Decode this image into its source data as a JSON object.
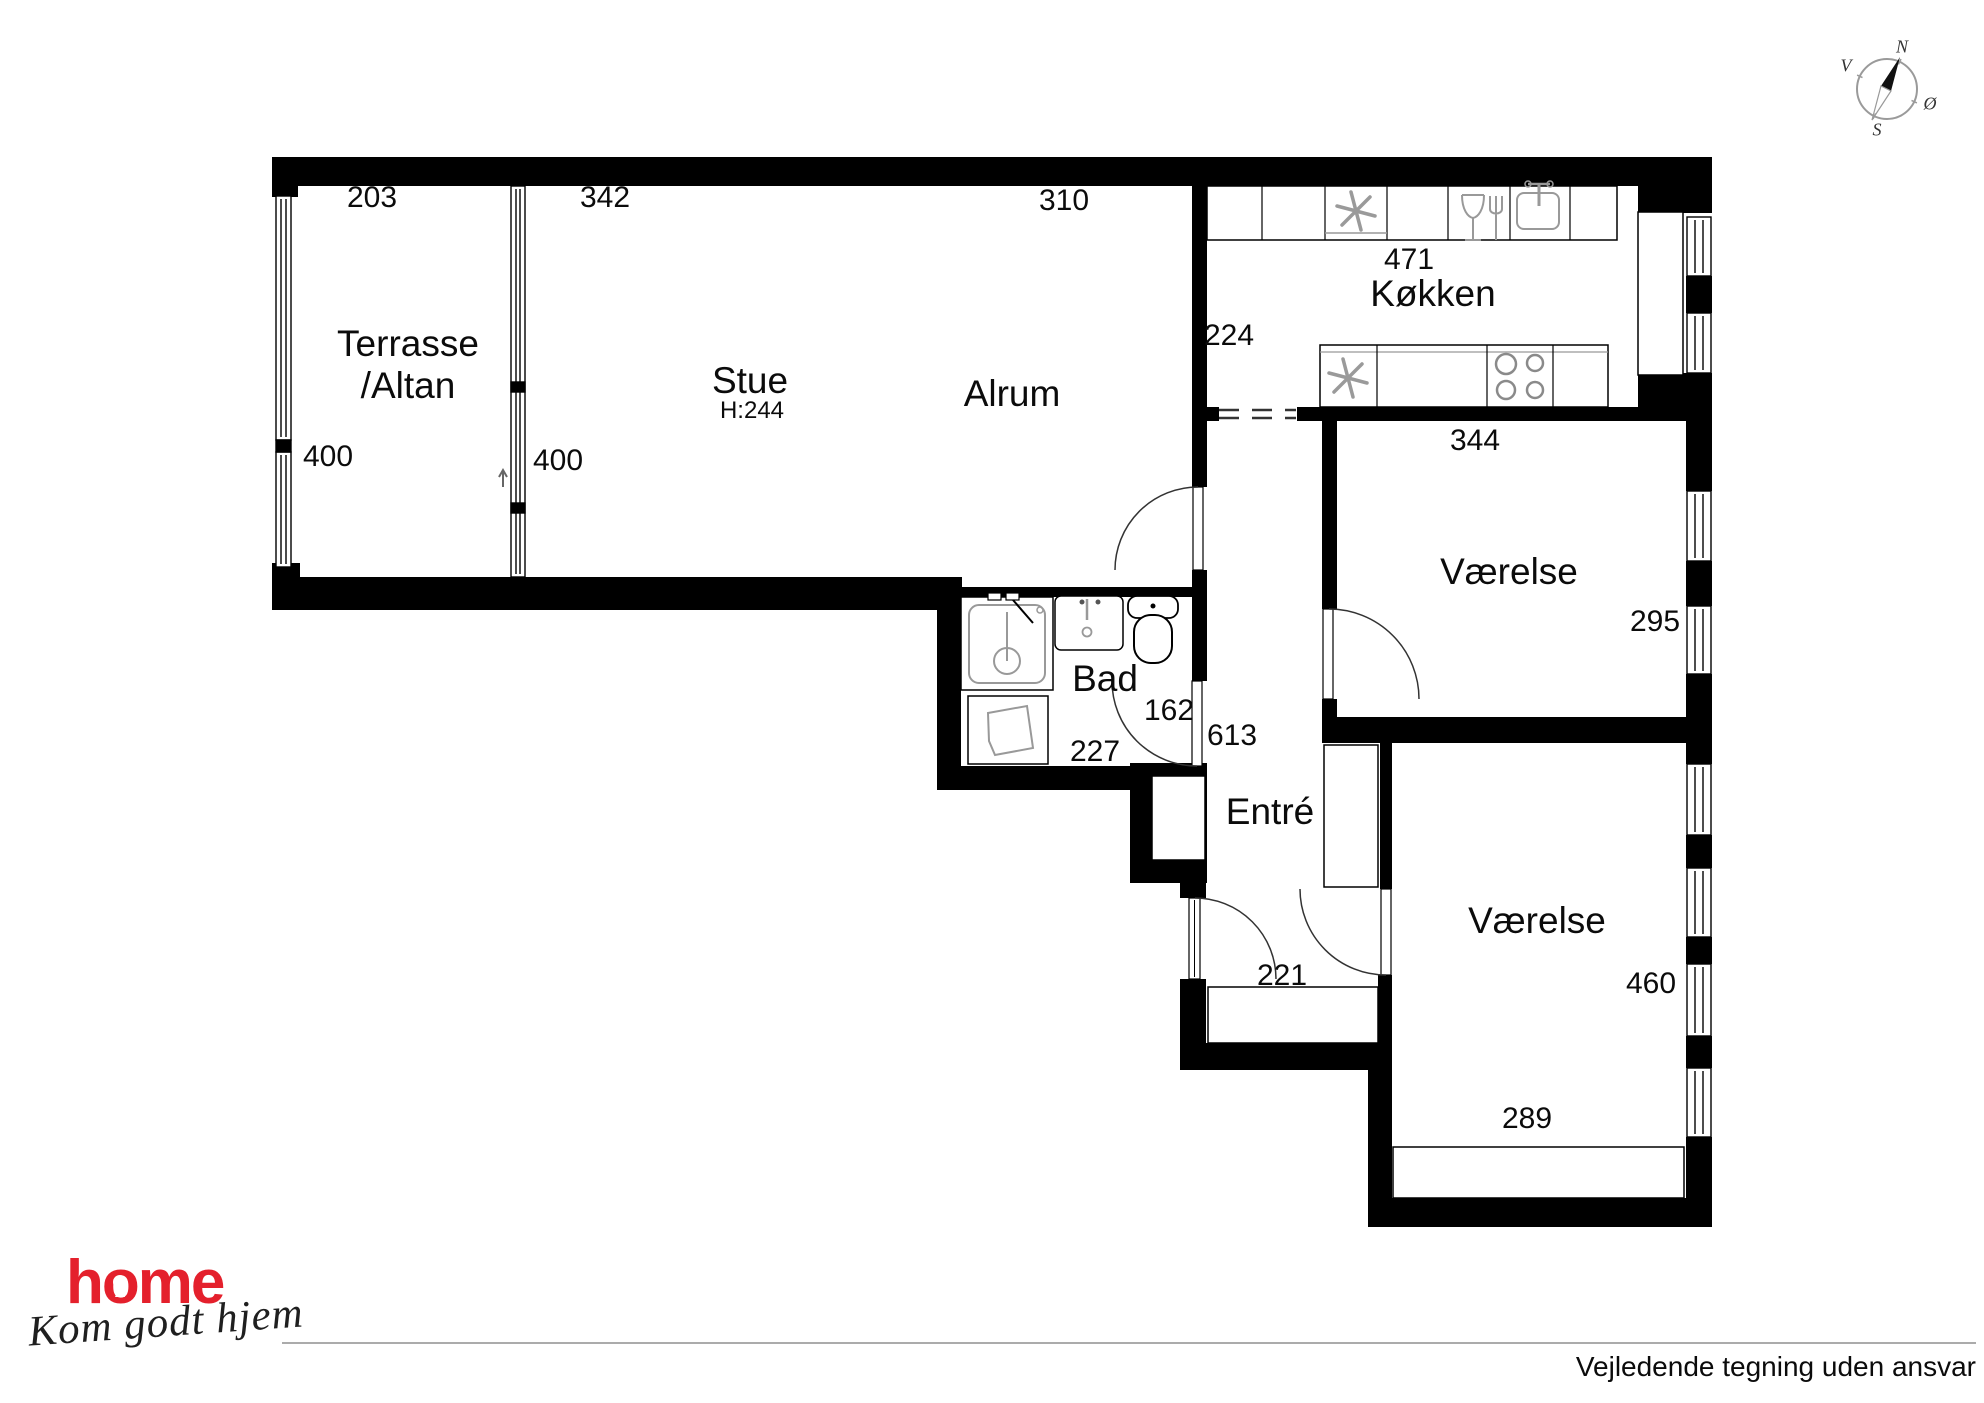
{
  "plan": {
    "rooms": {
      "terrasse": {
        "name_line1": "Terrasse",
        "name_line2": "/Altan",
        "dim_width": "203",
        "dim_height_left": "400",
        "dim_height_right": "400"
      },
      "stue": {
        "name": "Stue",
        "ceiling_height": "H:244",
        "dim_width": "342"
      },
      "alrum": {
        "name": "Alrum",
        "dim_width": "310"
      },
      "kokken": {
        "name": "Køkken",
        "dim_length": "471",
        "dim_opening": "224"
      },
      "bad": {
        "name": "Bad",
        "dim_width": "227",
        "dim_door_side": "162"
      },
      "entre": {
        "name": "Entré",
        "dim_length": "613",
        "dim_width": "221"
      },
      "vaerelse_nord": {
        "name": "Værelse",
        "dim_width": "344",
        "dim_depth": "295"
      },
      "vaerelse_syd": {
        "name": "Værelse",
        "dim_depth": "460",
        "dim_width": "289"
      }
    },
    "compass": {
      "north": "N",
      "south": "S",
      "east": "Ø",
      "west": "V"
    },
    "icons": {
      "kitchen_top": [
        "freezer-snowflake",
        "dishwasher-glass-fork",
        "sink-basin-faucet"
      ],
      "kitchen_bottom": [
        "freezer-snowflake",
        "stove-four-burners"
      ],
      "bathroom": [
        "shower",
        "washing-machine",
        "hand-basin",
        "toilet"
      ]
    }
  },
  "footer": {
    "brand": "home",
    "tagline": "Kom godt hjem",
    "brand_color": "#e4202c",
    "disclaimer": "Vejledende tegning uden ansvar"
  }
}
